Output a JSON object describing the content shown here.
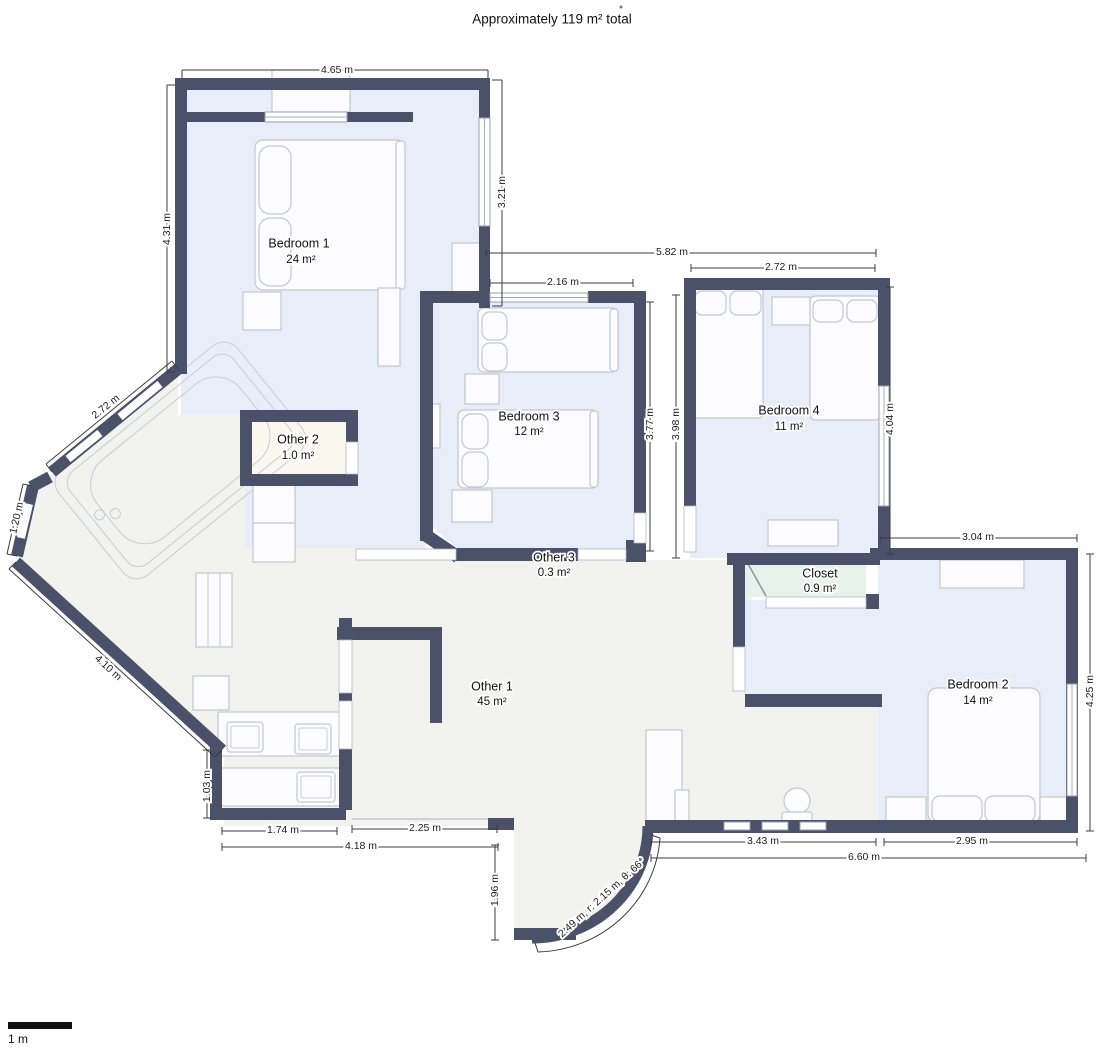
{
  "title": "Approximately 119 m² total",
  "rooms": [
    {
      "name": "Bedroom 1",
      "area": "24 m²"
    },
    {
      "name": "Bedroom 3",
      "area": "12 m²"
    },
    {
      "name": "Bedroom 4",
      "area": "11 m²"
    },
    {
      "name": "Bedroom 2",
      "area": "14 m²"
    },
    {
      "name": "Other 1",
      "area": "45 m²"
    },
    {
      "name": "Other 2",
      "area": "1.0 m²"
    },
    {
      "name": "Other 3",
      "area": "0.3 m²"
    },
    {
      "name": "Closet",
      "area": "0.9 m²"
    }
  ],
  "dimensions": {
    "b1_width": "4.65 m",
    "b1_left": "4.31 m",
    "b1_right": "3.21 m",
    "top_span": "5.82 m",
    "b3_top": "2.16 m",
    "b4_top": "2.72 m",
    "b3_right": "3.77 m",
    "b3_right_outer": "3.98 m",
    "b4_right": "4.04 m",
    "diag_upper": "2.72 m",
    "diag_mid": "1.20 m",
    "diag_lower": "4.10 m",
    "kitchen_left": "1.03 m",
    "kitchen_bottom": "1.74 m",
    "entry_bottom": "2.25 m",
    "bottom_left_span": "4.18 m",
    "entry_left": "1.96 m",
    "arc_wall": "2.49 m, r: 2.15 m, θ: 66°",
    "toilet_bottom": "3.43 m",
    "b2_bottom": "2.95 m",
    "bottom_right_span": "6.60 m",
    "b2_top": "3.04 m",
    "b2_right": "4.25 m"
  },
  "scale_bar": {
    "label": "1 m"
  },
  "colors": {
    "wall": "#4a5168",
    "bedroom_fill": "#e9edf7",
    "other_fill": "#f2f2ef",
    "other2_fill": "#faf7ef",
    "closet_fill": "#e7f3ea"
  }
}
